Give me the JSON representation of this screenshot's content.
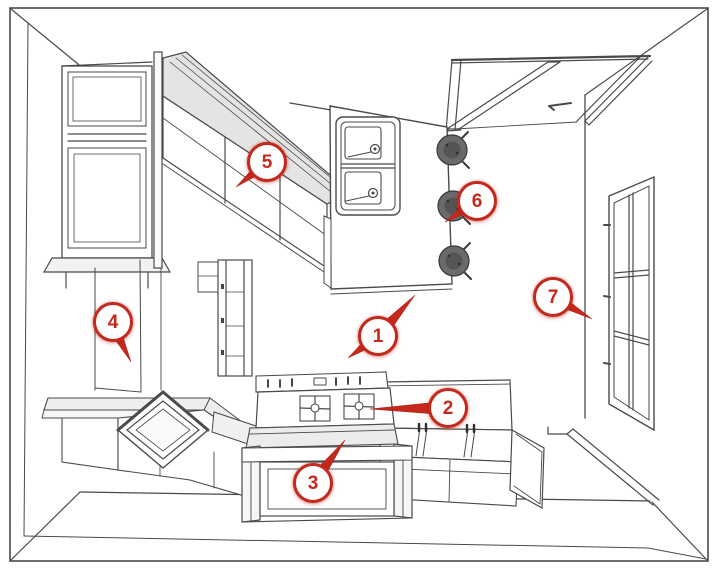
{
  "figure": {
    "kind": "kitchen-perspective-line-drawing",
    "background_color": "#ffffff",
    "line_color": "#4a4a4a",
    "marker_color": "#c5281c"
  },
  "markers": [
    {
      "number": "1",
      "points_to": "kitchen-island"
    },
    {
      "number": "2",
      "points_to": "base-cabinets-counter"
    },
    {
      "number": "3",
      "points_to": "range-cooktop"
    },
    {
      "number": "4",
      "points_to": "left-wall-tall-cabinet"
    },
    {
      "number": "5",
      "points_to": "upper-wall-cabinets"
    },
    {
      "number": "6",
      "points_to": "bar-stools"
    },
    {
      "number": "7",
      "points_to": "window"
    }
  ],
  "drawing_elements": [
    "room-walls",
    "doorway-opening",
    "casement-window",
    "glass-front-hutch",
    "upper-wall-cabinets",
    "tall-slim-cabinet",
    "corner-base-cabinet-sink",
    "range-with-oven",
    "base-cabinets",
    "kitchen-island",
    "double-bowl-sink",
    "bar-stools",
    "baseboard-trim"
  ]
}
